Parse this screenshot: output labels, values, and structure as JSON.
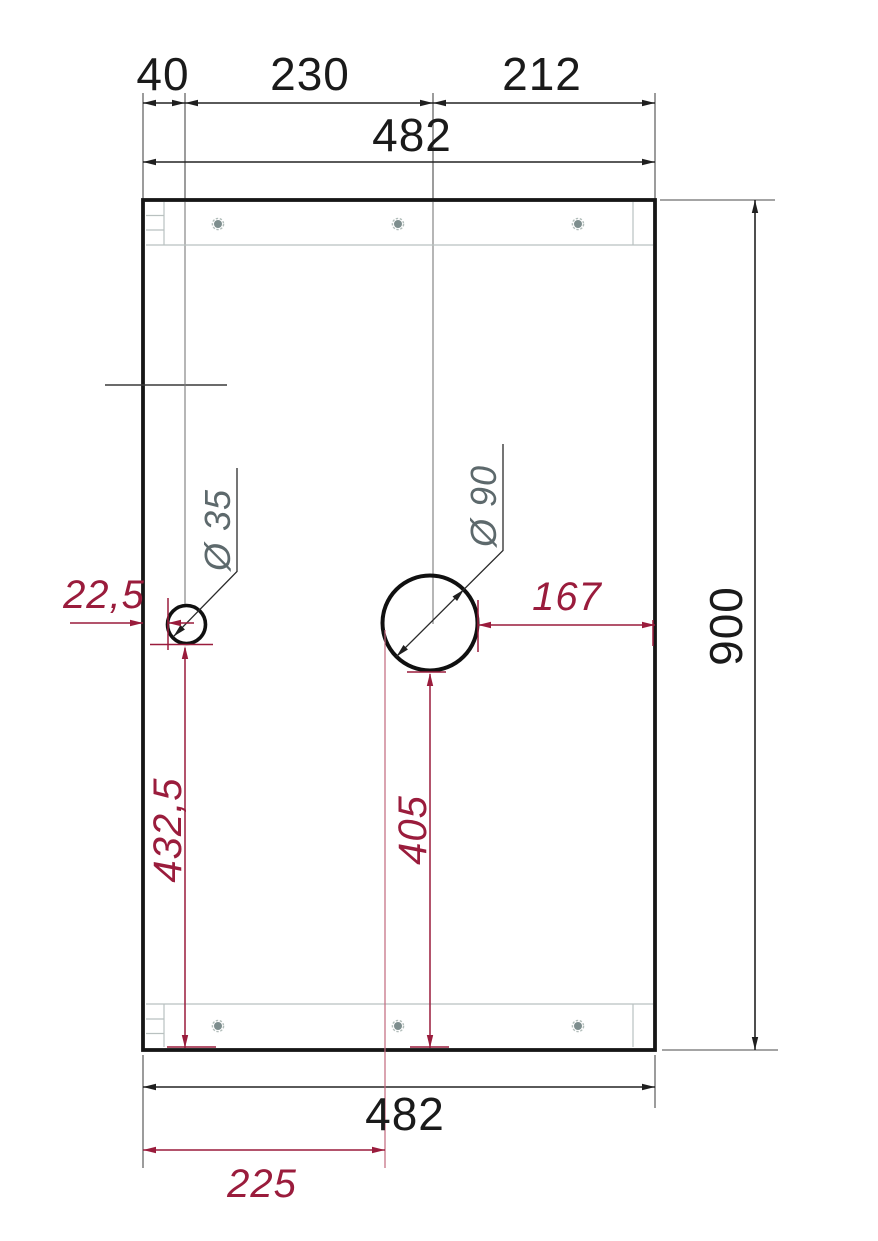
{
  "drawing": {
    "type": "technical-drawing",
    "colors": {
      "line_black": "#1f1f1f",
      "dim_text": "#1a1a1a",
      "red_accent": "#9a1c3c",
      "label_gray": "#5d696c",
      "rail_gray": "#b9c1c0",
      "screw_gray": "#7e8e8e"
    },
    "dims": {
      "seg_40": "40",
      "seg_230": "230",
      "seg_212": "212",
      "width_top": "482",
      "width_bottom": "482",
      "height": "900",
      "offset_small_hole_left": "22,5",
      "offset_large_hole_right": "167",
      "offset_small_hole_bottom": "432,5",
      "offset_large_hole_bottom": "405",
      "offset_large_hole_left_edge": "225",
      "dia_small": "Ø 35",
      "dia_large": "Ø 90"
    }
  }
}
